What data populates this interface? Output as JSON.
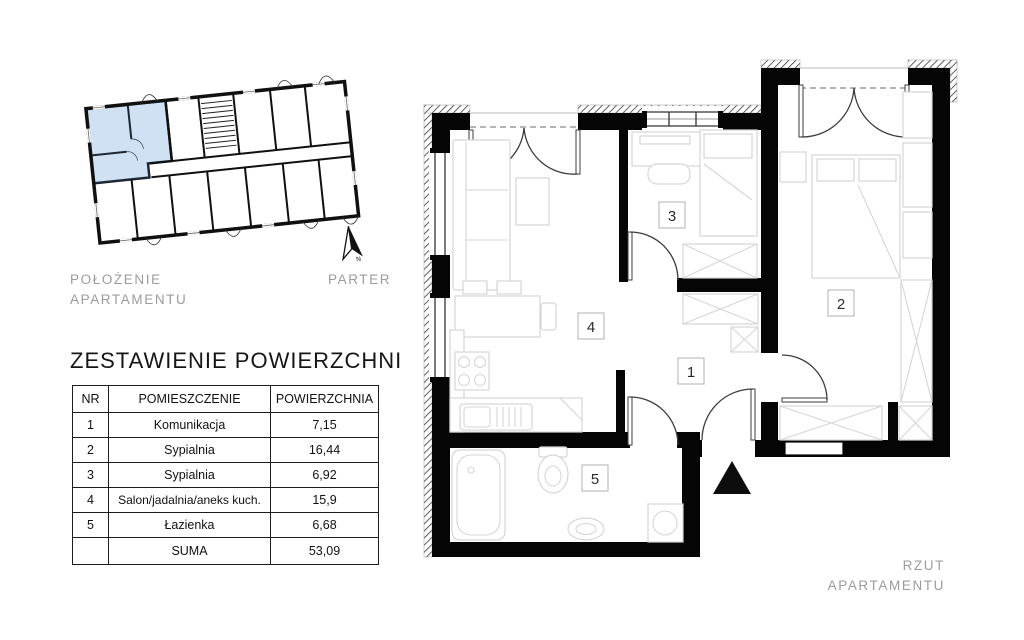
{
  "location_plan": {
    "caption_line1": "POŁOŻENIE",
    "caption_line2": "APARTAMENTU",
    "floor_label": "PARTER",
    "north_label": "N",
    "highlight_color": "#cfe1f2"
  },
  "area_table": {
    "title": "ZESTAWIENIE POWIERZCHNI",
    "headers": [
      "NR",
      "POMIESZCZENIE",
      "POWIERZCHNIA"
    ],
    "rows": [
      {
        "nr": "1",
        "room": "Komunikacja",
        "area": "7,15"
      },
      {
        "nr": "2",
        "room": "Sypialnia",
        "area": "16,44"
      },
      {
        "nr": "3",
        "room": "Sypialnia",
        "area": "6,92"
      },
      {
        "nr": "4",
        "room": "Salon/jadalnia/aneks kuch.",
        "area": "15,9"
      },
      {
        "nr": "5",
        "room": "Łazienka",
        "area": "6,68"
      }
    ],
    "total_label": "SUMA",
    "total_value": "53,09"
  },
  "floor_plan": {
    "caption": "RZUT APARTAMENTU",
    "room_numbers": [
      "1",
      "2",
      "3",
      "4",
      "5"
    ]
  },
  "colors": {
    "wall": "#050505",
    "highlight": "#cfe1f2",
    "caption_gray": "#9c9c9c"
  }
}
